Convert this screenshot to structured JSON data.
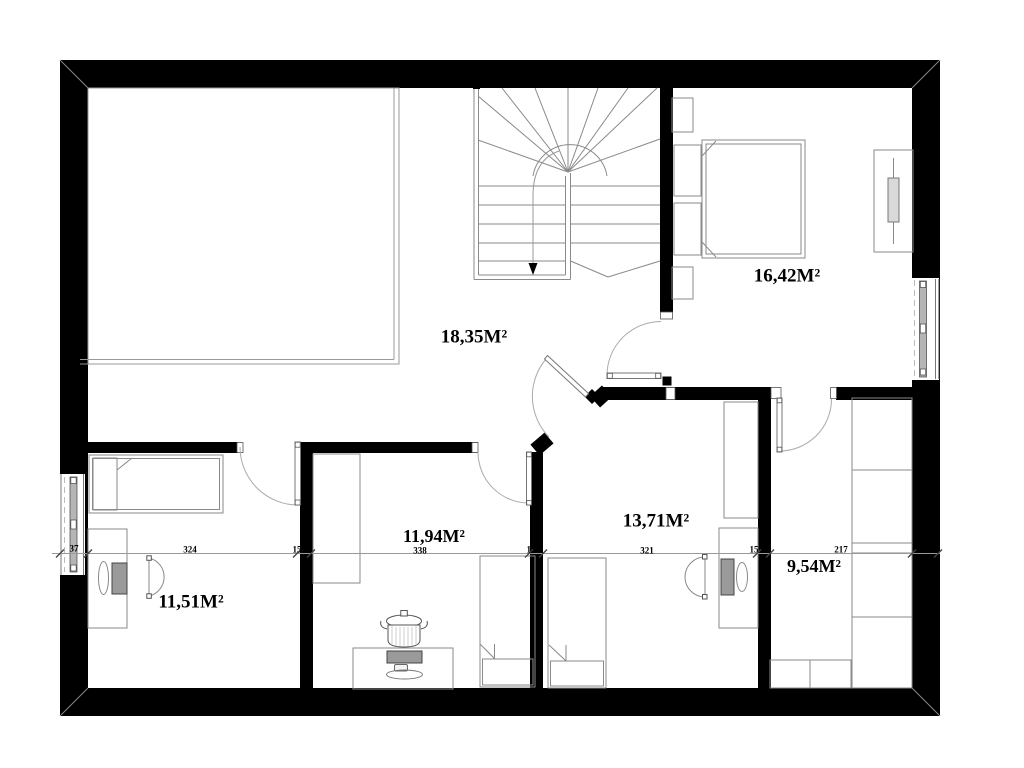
{
  "plan": {
    "type": "floor-plan",
    "rooms": [
      {
        "name": "hall-landing",
        "area": "18,35M²"
      },
      {
        "name": "master-bedroom",
        "area": "16,42M²"
      },
      {
        "name": "bedroom-left",
        "area": "11,51M²"
      },
      {
        "name": "bedroom-middle",
        "area": "11,94M²"
      },
      {
        "name": "bedroom-right",
        "area": "13,71M²"
      },
      {
        "name": "walk-in-closet",
        "area": "9,54M²"
      }
    ],
    "dimensions_cm": [
      "37",
      "324",
      "15",
      "338",
      "15",
      "321",
      "15",
      "217"
    ],
    "colors": {
      "wall": "#000000",
      "thin_line": "#8a8a8a",
      "door_arc": "#aaaaaa",
      "fill_gray": "#9a9a9a",
      "background": "#ffffff",
      "text": "#000000"
    }
  }
}
